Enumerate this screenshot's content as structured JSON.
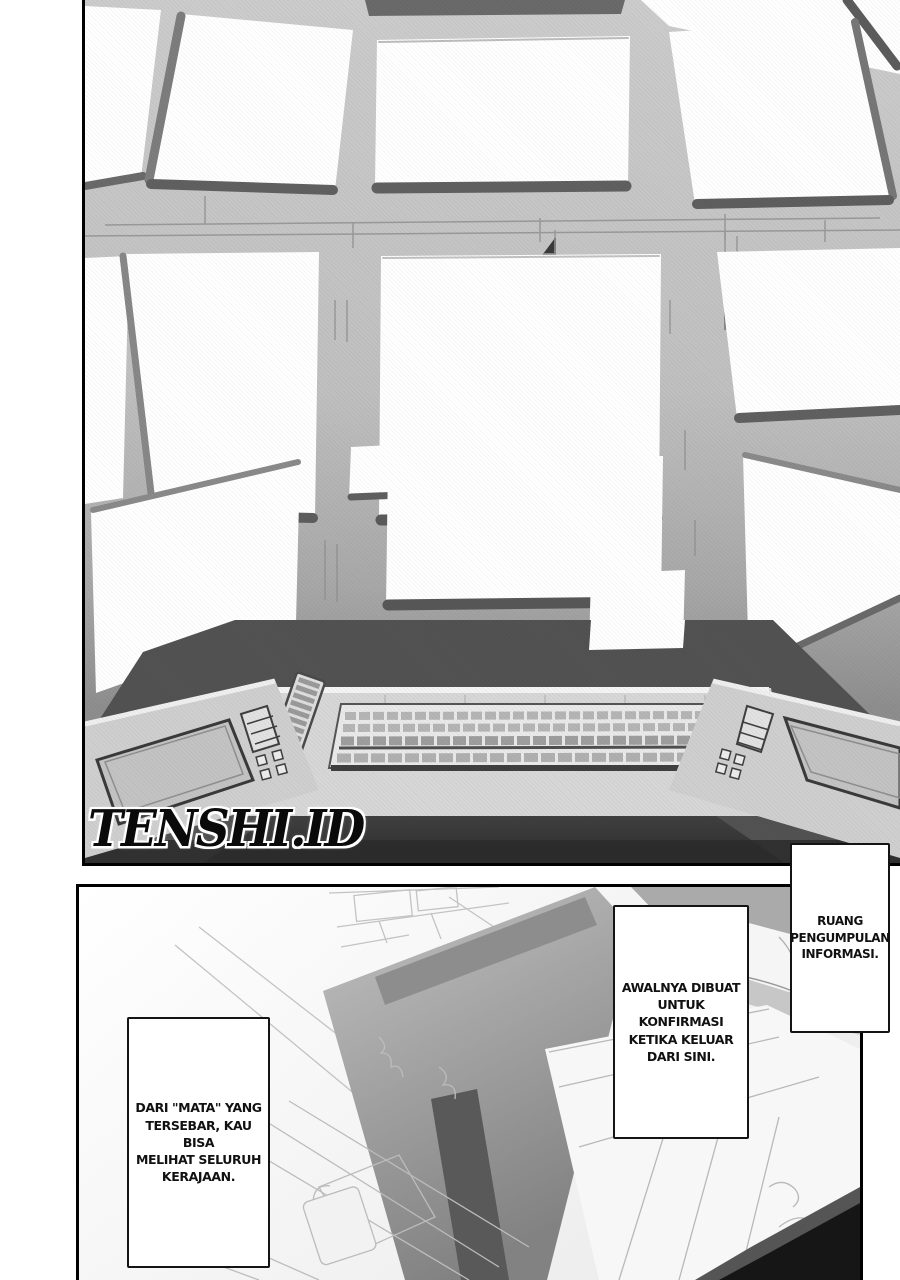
{
  "page": {
    "watermark": "TENSHI.ID"
  },
  "panels": {
    "top": {
      "description": "control room wall covered in blank white monitor screens above a U-shaped console desk with keyboards"
    },
    "bottom": {
      "description": "overhead view of the information gathering room with desks and maps"
    }
  },
  "speech_bubbles": [
    {
      "id": "ruang",
      "text": "RUANG\nPENGUMPULAN\nINFORMASI."
    },
    {
      "id": "awalnya",
      "text": "AWALNYA DIBUAT\nUNTUK KONFIRMASI\nKETIKA KELUAR\nDARI SINI."
    },
    {
      "id": "darimata",
      "text": "DARI \"MATA\" YANG\nTERSEBAR, KAU BISA\nMELIHAT SELURUH\nKERAJAAN."
    }
  ],
  "colors": {
    "ink": "#141414",
    "paper": "#ffffff",
    "wall_gray": "#bfbfbf",
    "console_dark": "#4e4e4e",
    "floor_dark": "#3b3b3b"
  }
}
